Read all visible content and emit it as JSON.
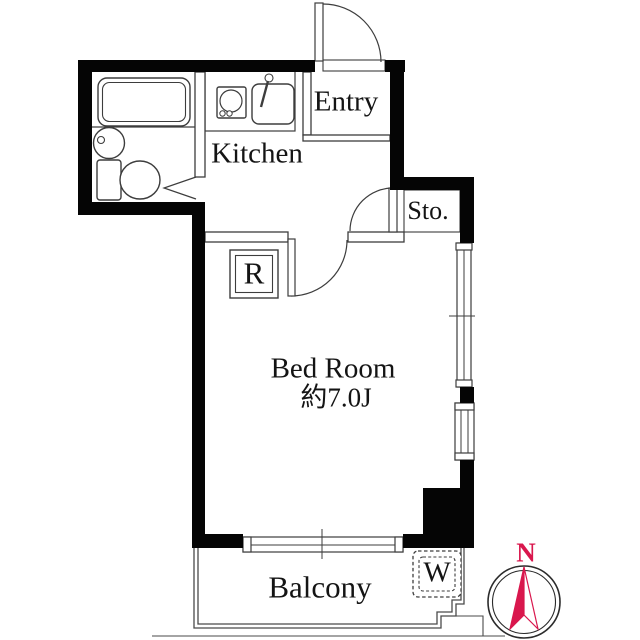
{
  "rooms": {
    "kitchen": {
      "label": "Kitchen"
    },
    "entry": {
      "label": "Entry"
    },
    "storage": {
      "label": "Sto."
    },
    "bedroom": {
      "label": "Bed Room",
      "size": "約7.0J"
    },
    "balcony": {
      "label": "Balcony"
    }
  },
  "markers": {
    "refrigerator": {
      "label": "R"
    },
    "washing_machine": {
      "label": "W"
    }
  },
  "compass": {
    "north_label": "N"
  },
  "colors": {
    "wall": "#050505",
    "outline": "#3d3d3d",
    "compass_red": "#d9174d"
  }
}
